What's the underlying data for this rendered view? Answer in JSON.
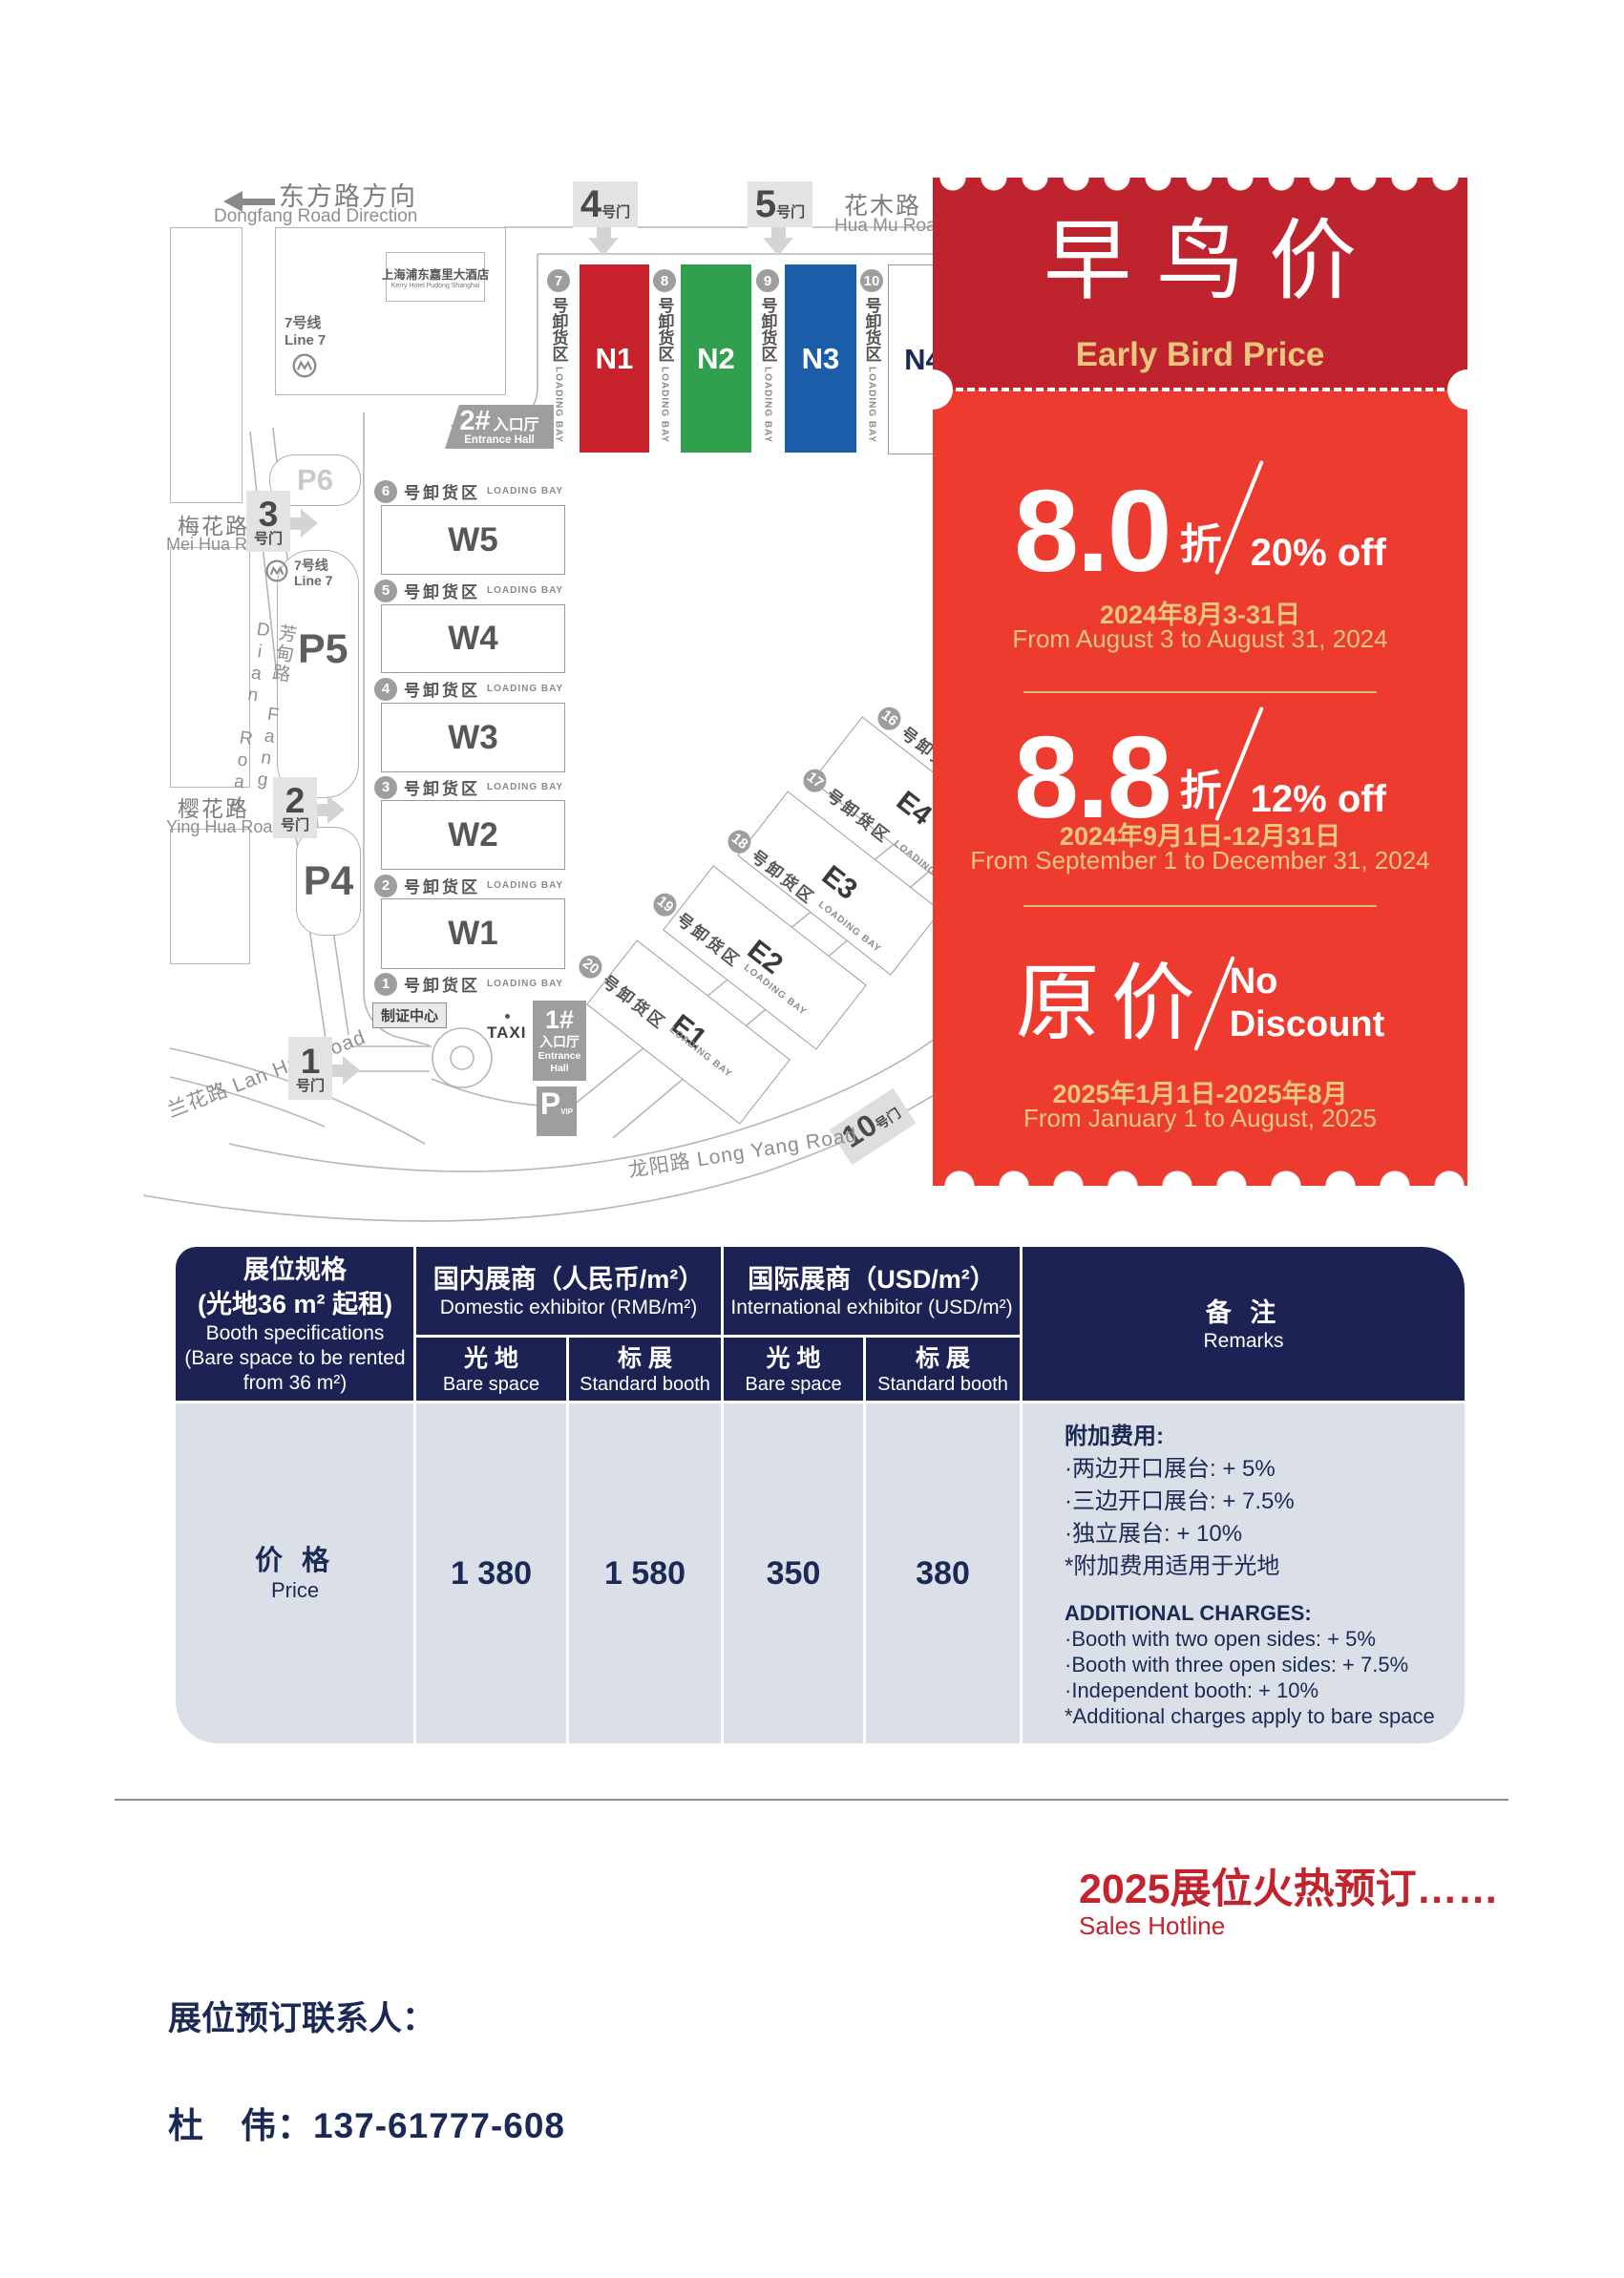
{
  "map": {
    "direction": {
      "cn": "东方路方向",
      "en": "Dongfang Road Direction"
    },
    "hotel": {
      "name_cn": "上海浦东嘉里大酒店",
      "name_en": "Kerry Hotel Pudong Shanghai"
    },
    "metro": {
      "cn": "7号线",
      "en": "Line 7"
    },
    "roads": {
      "huamu_cn": "花木路",
      "huamu_en": "Hua Mu Road",
      "meihua_cn": "梅花路",
      "meihua_en": "Mei Hua Road",
      "yinghua_cn": "樱花路",
      "yinghua_en": "Ying Hua Road",
      "fangdian": "芳甸路 Fang Dian Road",
      "lanhua": "兰花路 Lan Hua Road",
      "longyang": "龙阳路  Long Yang Road"
    },
    "gates": {
      "g1": "1",
      "g2": "2",
      "g3": "3",
      "g4": "4",
      "g5": "5",
      "g10": "10",
      "suffix": "号门"
    },
    "entrances": {
      "e1_num": "1#",
      "e2_num": "2#",
      "hall_cn": "入口厅",
      "hall_en": "Entrance Hall"
    },
    "parking": {
      "p6": "P6",
      "p5": "P5",
      "p4": "P4",
      "p": "P",
      "vip": "VIP"
    },
    "badge_center": "制证中心",
    "taxi": "TAXI",
    "halls": {
      "n1": "N1",
      "n2": "N2",
      "n3": "N3",
      "n4": "N4",
      "w1": "W1",
      "w2": "W2",
      "w3": "W3",
      "w4": "W4",
      "w5": "W5",
      "e1": "E1",
      "e2": "E2",
      "e3": "E3",
      "e4": "E4"
    },
    "loading": {
      "cn": "号卸货区",
      "en": "LOADING BAY",
      "n": [
        "7",
        "8",
        "9",
        "10"
      ],
      "w": [
        "6",
        "5",
        "4",
        "3",
        "2",
        "1"
      ],
      "e": [
        "16",
        "17",
        "18",
        "19",
        "20"
      ]
    }
  },
  "ticket": {
    "title_cn": "早鸟价",
    "title_en": "Early Bird Price",
    "tier1": {
      "value": "8.0",
      "unit": "折",
      "off": "20% off",
      "date_cn": "2024年8月3-31日",
      "date_en": "From August 3 to August 31, 2024"
    },
    "tier2": {
      "value": "8.8",
      "unit": "折",
      "off": "12% off",
      "date_cn": "2024年9月1日-12月31日",
      "date_en": "From September 1 to December 31, 2024"
    },
    "tier3": {
      "value": "原价",
      "off1": "No",
      "off2": "Discount",
      "date_cn": "2025年1月1日-2025年8月",
      "date_en": "From January 1 to August, 2025"
    }
  },
  "table": {
    "spec": {
      "cn1": "展位规格",
      "cn2": "(光地36 m² 起租)",
      "en1": "Booth specifications",
      "en2": "(Bare space to be rented",
      "en3": "from 36 m²)"
    },
    "domestic": {
      "cn": "国内展商（人民币/m²）",
      "en": "Domestic exhibitor (RMB/m²)"
    },
    "intl": {
      "cn": "国际展商（USD/m²）",
      "en": "International exhibitor (USD/m²)"
    },
    "bare": {
      "cn": "光 地",
      "en": "Bare space"
    },
    "std": {
      "cn": "标 展",
      "en": "Standard booth"
    },
    "remarks_head": {
      "cn": "备 注",
      "en": "Remarks"
    },
    "row": {
      "cn": "价 格",
      "en": "Price",
      "values": [
        "1 380",
        "1 580",
        "350",
        "380"
      ]
    },
    "remarks": {
      "cn_title": "附加费用:",
      "cn1": "·两边开口展台: + 5%",
      "cn2": "·三边开口展台: + 7.5%",
      "cn3": "·独立展台: + 10%",
      "cn4": "*附加费用适用于光地",
      "en_title": "ADDITIONAL CHARGES:",
      "en1": "·Booth with two open sides: + 5%",
      "en2": "·Booth with three open sides: + 7.5%",
      "en3": "·Independent booth: + 10%",
      "en4": "*Additional charges apply to bare space"
    }
  },
  "footer": {
    "hot": "2025展位火热预订……",
    "hotline": "Sales Hotline",
    "contact_label": "展位预订联系人：",
    "contact": "杜　伟：137-61777-608"
  }
}
